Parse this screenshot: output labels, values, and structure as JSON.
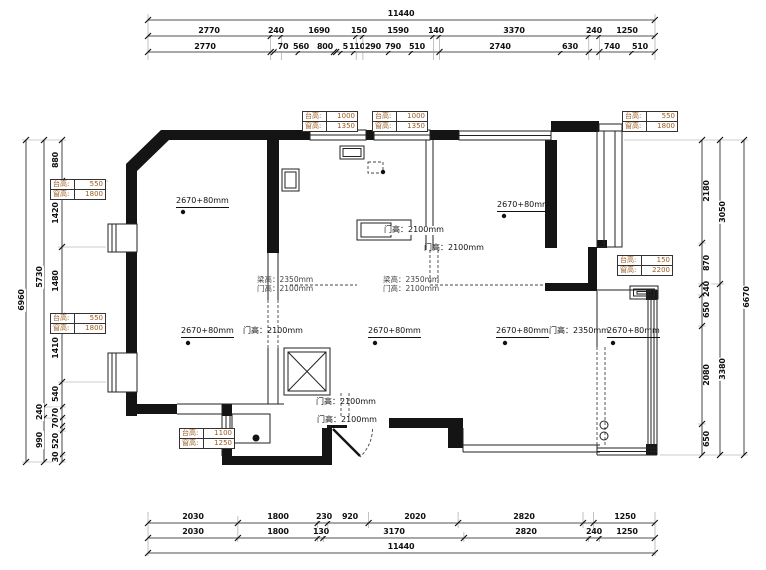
{
  "dims": {
    "top": {
      "total": "11440",
      "row1": [
        "2770",
        "240",
        "1690",
        "150",
        "1590",
        "140",
        "3370",
        "240",
        "1250"
      ],
      "row2": [
        "2770",
        "70",
        "560",
        "800",
        "50",
        "110",
        "290",
        "790",
        "510",
        "2740",
        "630",
        "740",
        "510"
      ]
    },
    "bottom": {
      "row1": [
        "2030",
        "1800",
        "230",
        "920",
        "2020",
        "2820",
        "1250"
      ],
      "row2": [
        "2030",
        "1800",
        "130",
        "3170",
        "2820",
        "240",
        "1250"
      ],
      "total": "11440"
    },
    "left": {
      "inner": [
        "880",
        "1420",
        "1480",
        "1410",
        "540",
        "170",
        "70",
        "520",
        "30"
      ],
      "mid": [
        "5730",
        "240",
        "990"
      ],
      "outer": "6960"
    },
    "right": {
      "inner": [
        "2180",
        "870",
        "240",
        "650",
        "2080",
        "650"
      ],
      "mid": [
        "3050",
        "3380"
      ],
      "outer": "6670"
    }
  },
  "plan": {
    "ceiling_label": "2670+80mm",
    "door_2100": "门高：2100mm",
    "door_2350": "门高：2350mm",
    "beam_2350": "梁高：2350mm",
    "boxes": [
      {
        "rows": [
          [
            "台高:",
            "1000"
          ],
          [
            "窗高:",
            "1350"
          ]
        ]
      },
      {
        "rows": [
          [
            "台高:",
            "1000"
          ],
          [
            "窗高:",
            "1350"
          ]
        ]
      },
      {
        "rows": [
          [
            "台高:",
            "550"
          ],
          [
            "窗高:",
            "1800"
          ]
        ]
      },
      {
        "rows": [
          [
            "台高:",
            "550"
          ],
          [
            "窗高:",
            "1800"
          ]
        ]
      },
      {
        "rows": [
          [
            "台高:",
            "550"
          ],
          [
            "窗高:",
            "1800"
          ]
        ]
      },
      {
        "rows": [
          [
            "台高:",
            "150"
          ],
          [
            "窗高:",
            "2200"
          ]
        ]
      },
      {
        "rows": [
          [
            "台高:",
            "1100"
          ],
          [
            "窗高:",
            "1250"
          ]
        ]
      }
    ]
  }
}
